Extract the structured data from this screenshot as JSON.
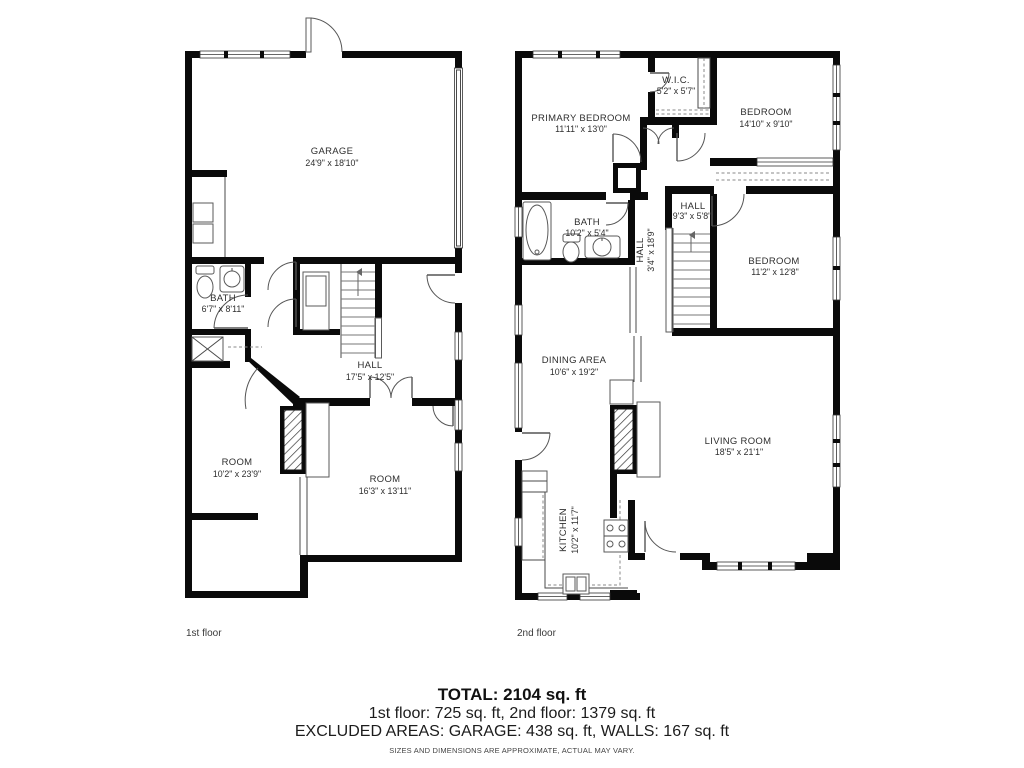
{
  "floors": [
    {
      "caption": "1st floor",
      "rooms": [
        {
          "name": "GARAGE",
          "dims": "24'9\" x 18'10\""
        },
        {
          "name": "BATH",
          "dims": "6'7\" x 8'11\""
        },
        {
          "name": "HALL",
          "dims": "17'5\" x 12'5\""
        },
        {
          "name": "ROOM",
          "dims": "10'2\" x 23'9\""
        },
        {
          "name": "ROOM",
          "dims": "16'3\" x 13'11\""
        }
      ]
    },
    {
      "caption": "2nd floor",
      "rooms": [
        {
          "name": "PRIMARY BEDROOM",
          "dims": "11'11\" x 13'0\""
        },
        {
          "name": "W.I.C.",
          "dims": "5'2\" x 5'7\""
        },
        {
          "name": "BEDROOM",
          "dims": "14'10\" x 9'10\""
        },
        {
          "name": "BATH",
          "dims": "10'2\" x 5'4\""
        },
        {
          "name": "HALL",
          "dims": "9'3\" x 5'8\""
        },
        {
          "name": "HALL",
          "dims": "3'4\" x 18'9\""
        },
        {
          "name": "BEDROOM",
          "dims": "11'2\" x 12'8\""
        },
        {
          "name": "DINING AREA",
          "dims": "10'6\" x 19'2\""
        },
        {
          "name": "LIVING ROOM",
          "dims": "18'5\" x 21'1\""
        },
        {
          "name": "KITCHEN",
          "dims": "10'2\" x 11'7\""
        }
      ]
    }
  ],
  "summary": {
    "total": "TOTAL: 2104 sq. ft",
    "floors_line": "1st floor: 725 sq. ft, 2nd floor: 1379 sq. ft",
    "excluded_line": "EXCLUDED AREAS: GARAGE: 438 sq. ft, WALLS: 167 sq. ft",
    "disclaimer": "SIZES AND DIMENSIONS ARE APPROXIMATE, ACTUAL MAY VARY."
  }
}
